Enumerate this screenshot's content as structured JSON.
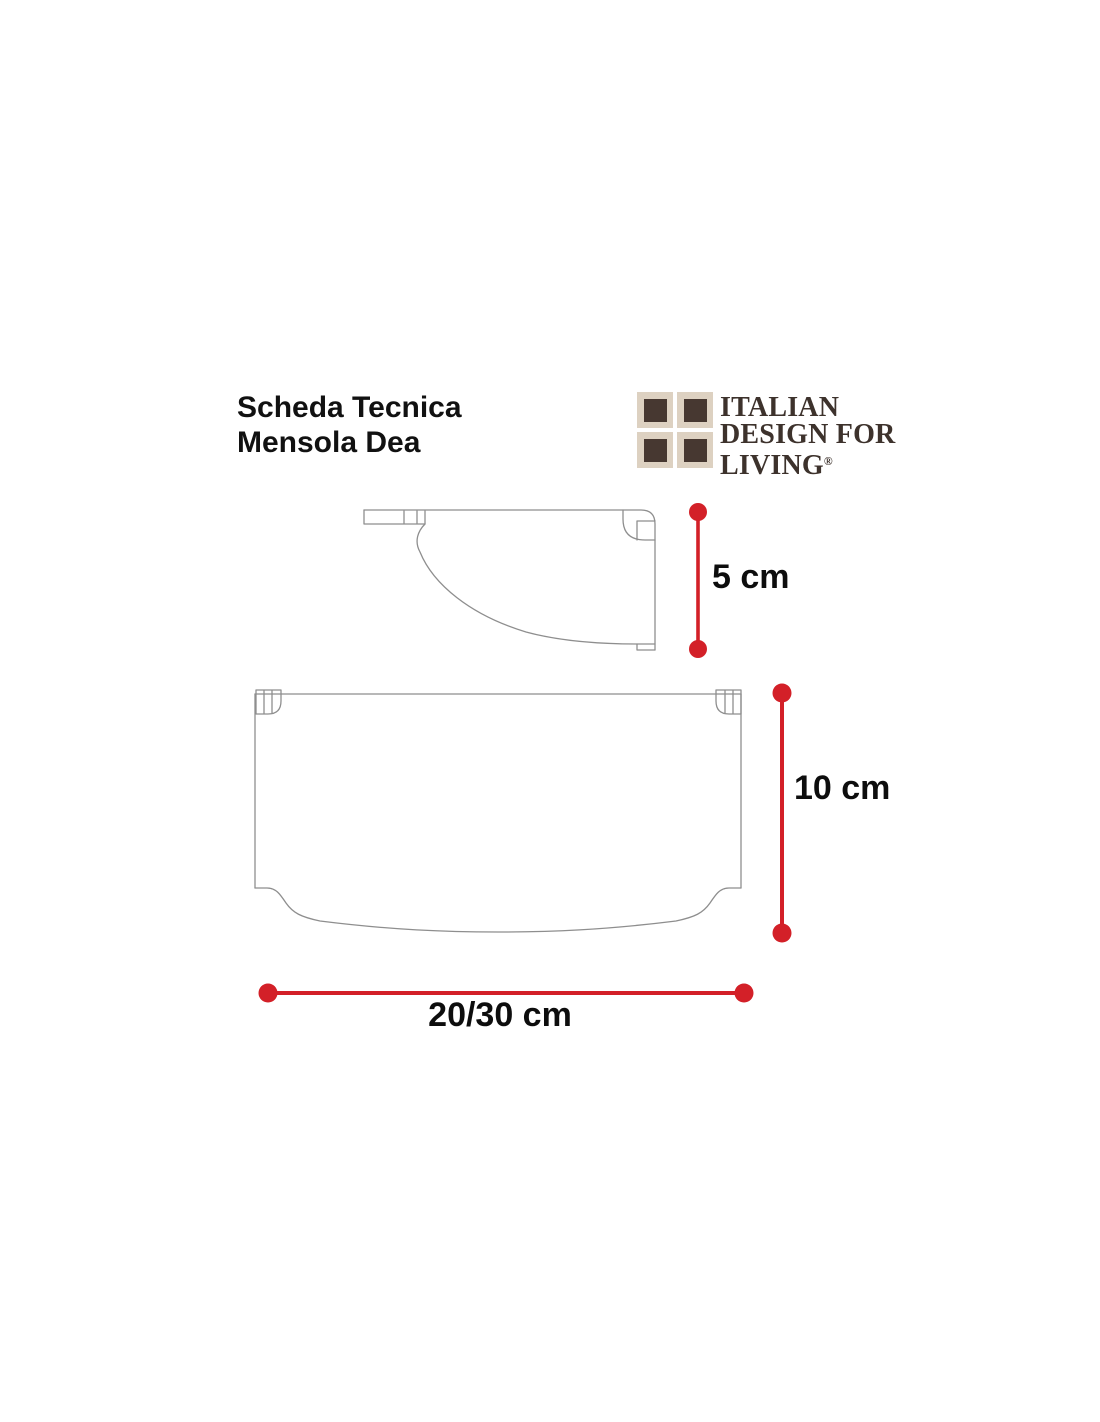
{
  "header": {
    "title_line1": "Scheda Tecnica",
    "title_line2": "Mensola Dea"
  },
  "logo": {
    "line1": "ITALIAN",
    "line2": "DESIGN FOR",
    "line3": "LIVING",
    "registered_mark": "®",
    "colors": {
      "beige": "#ddd1c1",
      "brown": "#473831",
      "text": "#3d322c"
    }
  },
  "diagram": {
    "product": "Mensola Dea shelf",
    "views": [
      {
        "name": "side-profile-view"
      },
      {
        "name": "top-plan-view"
      }
    ],
    "dimensions": {
      "side_height": "5 cm",
      "plan_depth": "10 cm",
      "plan_width": "20/30 cm"
    },
    "colors": {
      "dimension_red": "#d32028",
      "line_gray": "#8e8e8e"
    }
  }
}
